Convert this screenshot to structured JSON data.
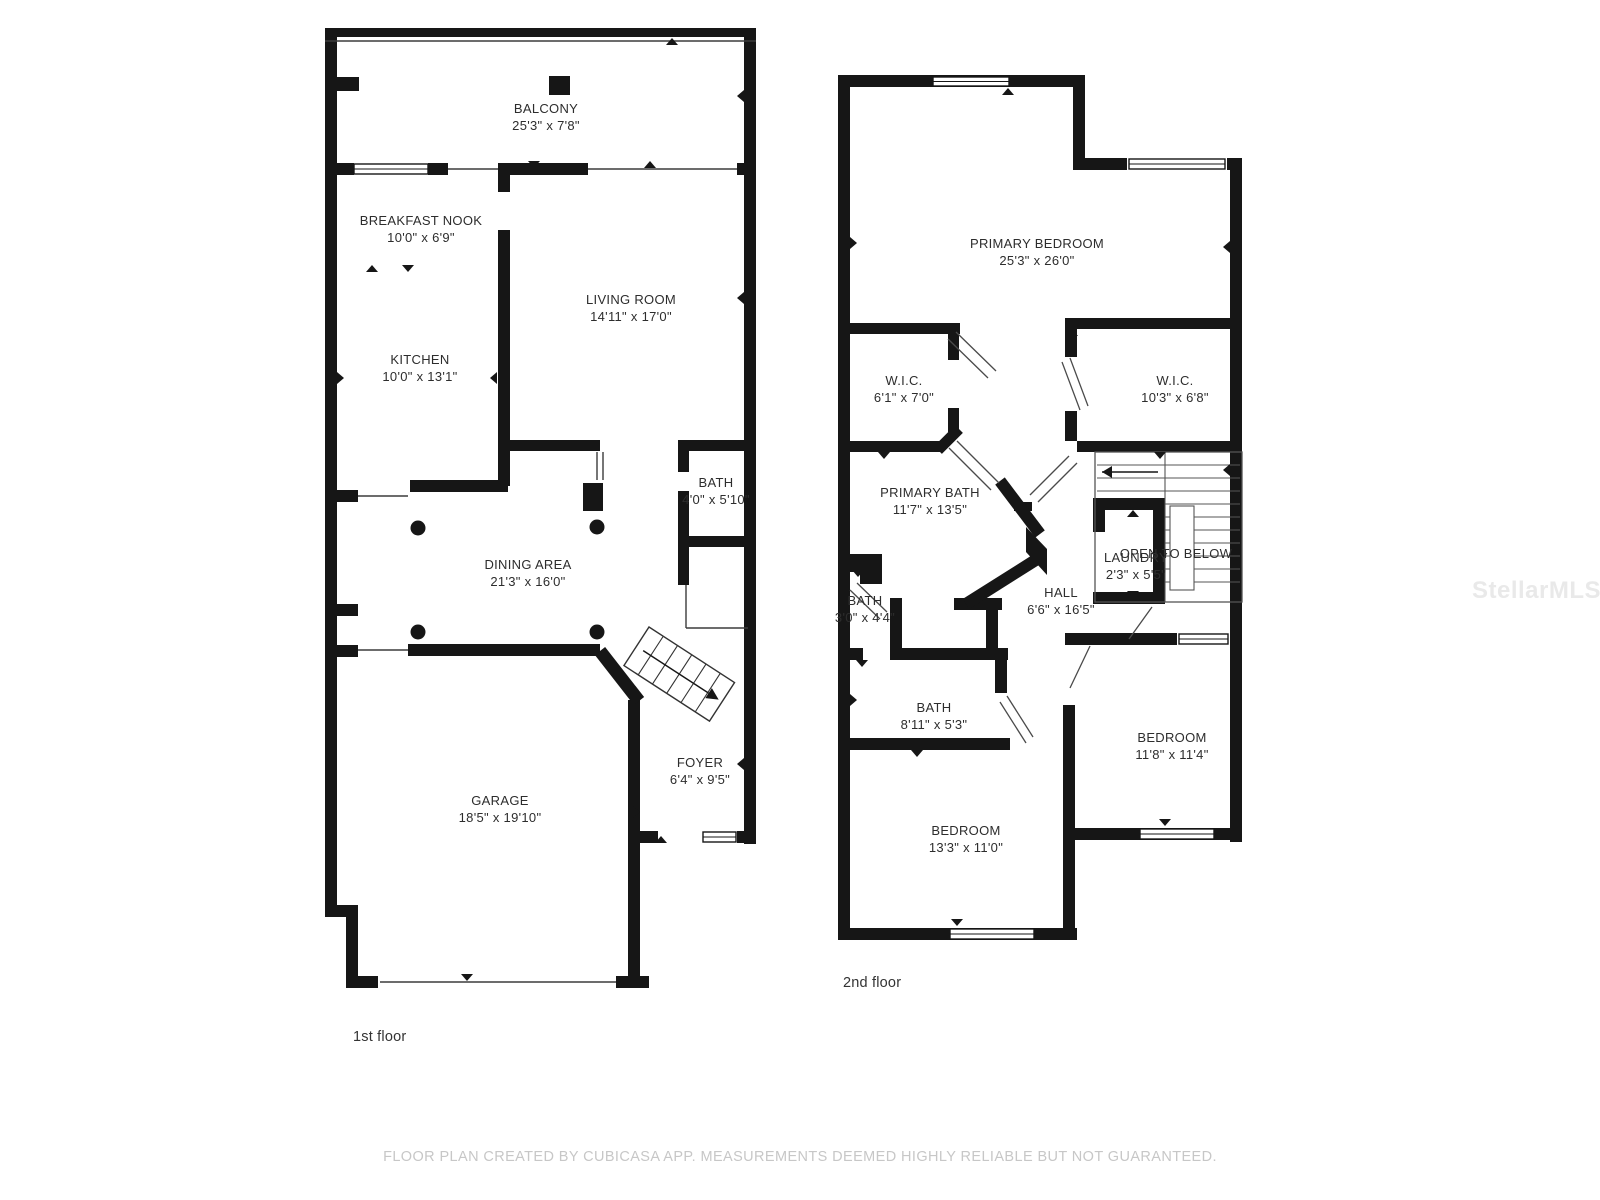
{
  "floors": [
    {
      "label": "1st floor",
      "rooms": [
        {
          "name": "BALCONY",
          "dims": "25'3\" x 7'8\""
        },
        {
          "name": "BREAKFAST NOOK",
          "dims": "10'0\" x 6'9\""
        },
        {
          "name": "LIVING ROOM",
          "dims": "14'11\" x 17'0\""
        },
        {
          "name": "KITCHEN",
          "dims": "10'0\" x 13'1\""
        },
        {
          "name": "BATH",
          "dims": "4'0\" x 5'10\""
        },
        {
          "name": "DINING AREA",
          "dims": "21'3\" x 16'0\""
        },
        {
          "name": "GARAGE",
          "dims": "18'5\" x 19'10\""
        },
        {
          "name": "FOYER",
          "dims": "6'4\" x 9'5\""
        }
      ]
    },
    {
      "label": "2nd floor",
      "rooms": [
        {
          "name": "PRIMARY BEDROOM",
          "dims": "25'3\" x 26'0\""
        },
        {
          "name": "W.I.C.",
          "dims": "6'1\" x 7'0\""
        },
        {
          "name": "W.I.C.",
          "dims": "10'3\" x 6'8\""
        },
        {
          "name": "PRIMARY BATH",
          "dims": "11'7\" x 13'5\""
        },
        {
          "name": "LAUNDRY",
          "dims": "2'3\" x 5'5\""
        },
        {
          "name": "OPEN TO BELOW",
          "dims": ""
        },
        {
          "name": "HALL",
          "dims": "6'6\" x 16'5\""
        },
        {
          "name": "BATH",
          "dims": "3'0\" x 4'4\""
        },
        {
          "name": "BATH",
          "dims": "8'11\" x 5'3\""
        },
        {
          "name": "BEDROOM",
          "dims": "11'8\" x 11'4\""
        },
        {
          "name": "BEDROOM",
          "dims": "13'3\" x 11'0\""
        }
      ]
    }
  ],
  "footer": "FLOOR PLAN CREATED BY CUBICASA APP. MEASUREMENTS DEEMED HIGHLY RELIABLE BUT NOT GUARANTEED.",
  "watermark": "StellarMLS",
  "colors": {
    "wall": "#161616",
    "text": "#2d2d2d",
    "footer": "#c7c7c7",
    "watermark": "#e9e9e9"
  }
}
